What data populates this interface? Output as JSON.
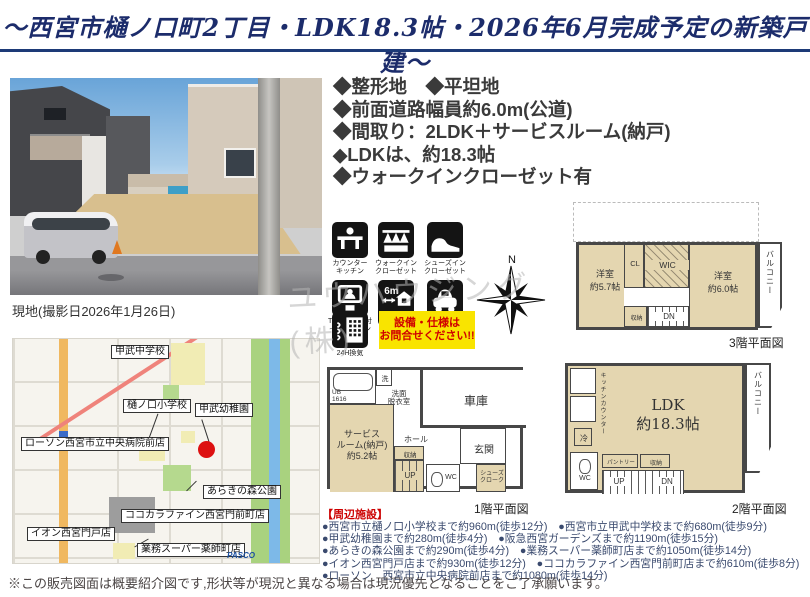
{
  "header": {
    "title": "〜西宮市樋ノ口町2丁目・LDK18.3帖・2026年6月完成予定の新築戸建〜"
  },
  "photo": {
    "caption": "現地(撮影日2026年1月26日)"
  },
  "features": [
    "◆整形地　◆平坦地",
    "◆前面道路幅員約6.0m(公道)",
    "◆間取り：2LDK＋サービスルーム(納戸)",
    "◆LDKは、約18.3帖",
    "◆ウォークインクローゼット有"
  ],
  "equipment": {
    "icons": [
      {
        "id": "counter-kitchen",
        "label": "カウンター\nキッチン"
      },
      {
        "id": "walk-in-closet",
        "label": "ウォークイン\nクローゼット"
      },
      {
        "id": "shoes-in-closet",
        "label": "シューズイン\nクローゼット"
      },
      {
        "id": "tv-monitor-intercom",
        "label": "TVモニター付\nインターホン"
      },
      {
        "id": "front-road-6m",
        "label": "前面道路幅員\n6m以上",
        "inner_text": "6m"
      },
      {
        "id": "parking",
        "label": "駐車場有"
      },
      {
        "id": "24h-ventilation",
        "label": "24H換気"
      }
    ],
    "note": "設備・仕様は\nお問合せください!!"
  },
  "compass": {
    "north": "N"
  },
  "watermark": "ユウハウジング(株)",
  "floorplans": {
    "f3": {
      "caption": "3階平面図",
      "rooms": {
        "west_room": "洋室\n約5.7帖",
        "cl": "CL",
        "wic": "WIC",
        "east_room": "洋室\n約6.0帖",
        "balcony": "バルコニー",
        "storage": "収納",
        "dn": "DN"
      }
    },
    "f1": {
      "caption": "1階平面図",
      "rooms": {
        "ub": "UB\n1616",
        "washer": "洗",
        "senmen": "洗面\n脱衣室",
        "garage": "車庫",
        "service_room": "サービス\nルーム(納戸)\n約5.2帖",
        "hall": "ホール",
        "entrance": "玄関",
        "storage": "収納",
        "up": "UP",
        "wc": "WC",
        "shoes_closet": "シューズ\nクローク"
      }
    },
    "f2": {
      "caption": "2階平面図",
      "rooms": {
        "ldk": "LDK\n約18.3帖",
        "balcony": "バルコニー",
        "kitchen_counter": "キッチンカウンター",
        "fridge": "冷",
        "wc": "WC",
        "pantry": "パントリー",
        "storage": "収納",
        "up": "UP",
        "dn": "DN"
      }
    }
  },
  "map": {
    "labels": [
      "甲武中学校",
      "樋ノ口小学校",
      "甲武幼稚園",
      "ローソン西宮市立中央病院前店",
      "あらきの森公園",
      "ココカラファイン西宮門前町店",
      "イオン西宮門戸店",
      "業務スーパー薬師町店"
    ],
    "logo": "PASCO"
  },
  "facilities": {
    "heading": "【周辺施設】",
    "lines": [
      "●西宮市立樋ノ口小学校まで約960m(徒歩12分)　●西宮市立甲武中学校まで約680m(徒歩9分)",
      "●甲武幼稚園まで約280m(徒歩4分)　●阪急西宮ガーデンズまで約1190m(徒歩15分)",
      "●あらきの森公園まで約290m(徒歩4分)　●業務スーパー薬師町店まで約1050m(徒歩14分)",
      "●イオン西宮門戸店まで約930m(徒歩12分)　●ココカラファイン西宮門前町店まで約610m(徒歩8分)",
      "●ローソン　西宮市立中央病院前店まで約1080m(徒歩14分)"
    ]
  },
  "disclaimer": "※この販売図面は概要紹介図です,形状等が現況と異なる場合は現況優先となることをご了承願います。",
  "colors": {
    "accent_navy": "#1d2d66",
    "highlight_yellow": "#f9e400",
    "alert_red": "#cc0000",
    "plan_tan": "#e4d6b0",
    "map_location_red": "#dd1111"
  }
}
